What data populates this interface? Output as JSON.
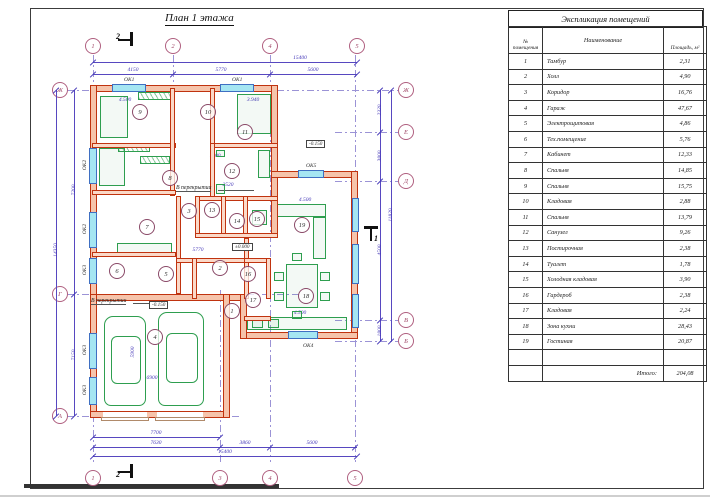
{
  "plan": {
    "title": "План 1 этажа",
    "axes": {
      "top": [
        "1",
        "2",
        "4",
        "5"
      ],
      "bottom": [
        "1",
        "3",
        "4",
        "5"
      ],
      "left": [
        "Ж",
        "Г",
        "А"
      ],
      "right": [
        "Ж",
        "Е",
        "Д",
        "В",
        "Б"
      ]
    },
    "dims": {
      "top_overall": "15400",
      "top_segments": [
        "4150",
        "5770",
        "5600"
      ],
      "bottom_row1": [
        "7700"
      ],
      "bottom_segments": [
        "7630",
        "3860",
        "5600"
      ],
      "bottom_overall": "15400",
      "left_segments": [
        "7200",
        "7150"
      ],
      "left_overall": "14350",
      "right_segments": [
        "2320",
        "3800",
        "4500",
        "1800"
      ],
      "right_overall": "11820",
      "inner": [
        "4.500",
        "3.940",
        "7400",
        "2520",
        "4.500",
        "5770",
        "5900",
        "6900",
        "4.500"
      ]
    },
    "window_labels": [
      "ОК1",
      "ОК1",
      "ОК2",
      "ОК2",
      "ОК3",
      "ОК3",
      "ОК3",
      "ОК5",
      "ОК4"
    ],
    "levels": [
      "-0.150",
      "±0.000",
      "-0.150"
    ],
    "notes": [
      "В перекрытии",
      "В перекрытии"
    ],
    "section_marks": [
      "2",
      "2",
      "1"
    ]
  },
  "table": {
    "title": "Экспликация помещений",
    "col_headers": {
      "num": "№ помещения",
      "name": "Наименование",
      "area": "Площадь, м²"
    },
    "rows": [
      {
        "num": "1",
        "name": "Тамбур",
        "area": "2,31"
      },
      {
        "num": "2",
        "name": "Холл",
        "area": "4,90"
      },
      {
        "num": "3",
        "name": "Коридор",
        "area": "16,76"
      },
      {
        "num": "4",
        "name": "Гараж",
        "area": "47,67"
      },
      {
        "num": "5",
        "name": "Электрощитовая",
        "area": "4,86"
      },
      {
        "num": "6",
        "name": "Тех.помещение",
        "area": "5,76"
      },
      {
        "num": "7",
        "name": "Кабинет",
        "area": "12,33"
      },
      {
        "num": "8",
        "name": "Спальня",
        "area": "14,85"
      },
      {
        "num": "9",
        "name": "Спальня",
        "area": "15,75"
      },
      {
        "num": "10",
        "name": "Кладовая",
        "area": "2,88"
      },
      {
        "num": "11",
        "name": "Спальня",
        "area": "13,79"
      },
      {
        "num": "12",
        "name": "Санузел",
        "area": "9,26"
      },
      {
        "num": "13",
        "name": "Постирочная",
        "area": "2,38"
      },
      {
        "num": "14",
        "name": "Туалет",
        "area": "1,78"
      },
      {
        "num": "15",
        "name": "Холодная кладовая",
        "area": "3,90"
      },
      {
        "num": "16",
        "name": "Гардероб",
        "area": "2,38"
      },
      {
        "num": "17",
        "name": "Кладовая",
        "area": "2,24"
      },
      {
        "num": "18",
        "name": "Зона кухни",
        "area": "28,43"
      },
      {
        "num": "19",
        "name": "Гостиная",
        "area": "20,87"
      }
    ],
    "total_label": "Итого:",
    "total_value": "204,08"
  },
  "colors": {
    "wall": "#c0330f",
    "window": "#a5e6f2",
    "furniture": "#2e9e4f",
    "dimension": "#4538b8",
    "axis": "#b06080"
  }
}
